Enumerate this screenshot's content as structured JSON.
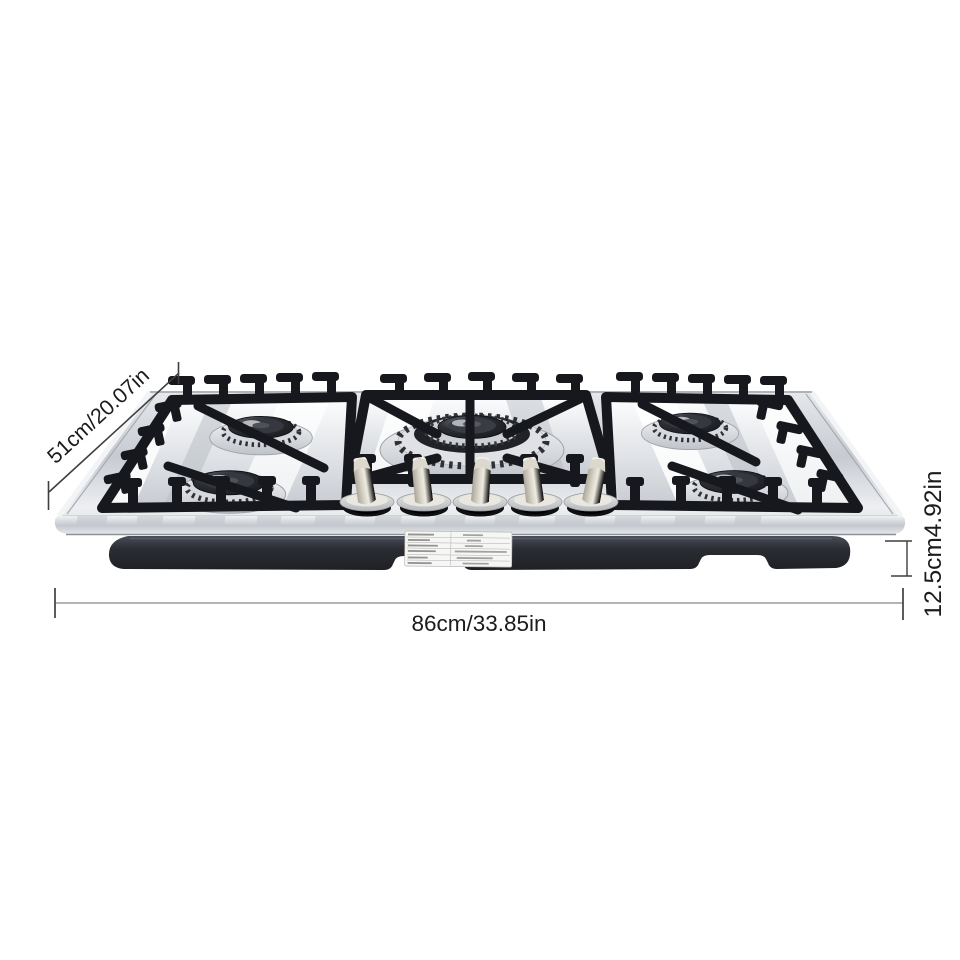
{
  "product": {
    "subject": "5-burner stainless steel built-in gas cooktop",
    "burner_count": 5,
    "knob_count": 5,
    "spec_label_present": true
  },
  "annotations": {
    "depth": "51cm/20.07in",
    "height": "12.5cm4.92in",
    "width": "86cm/33.85in"
  },
  "colors": {
    "background": "#ffffff",
    "annotation_text": "#1c1c1c",
    "annotation_line": "#3f3f3f",
    "ruler_line": "#9b9b9b",
    "steel_light": "#f1f2f4",
    "steel_mid": "#c6cad0",
    "grate": "#17181d",
    "body_tub": "#2a2d34",
    "knob": "#cfc9bc"
  }
}
